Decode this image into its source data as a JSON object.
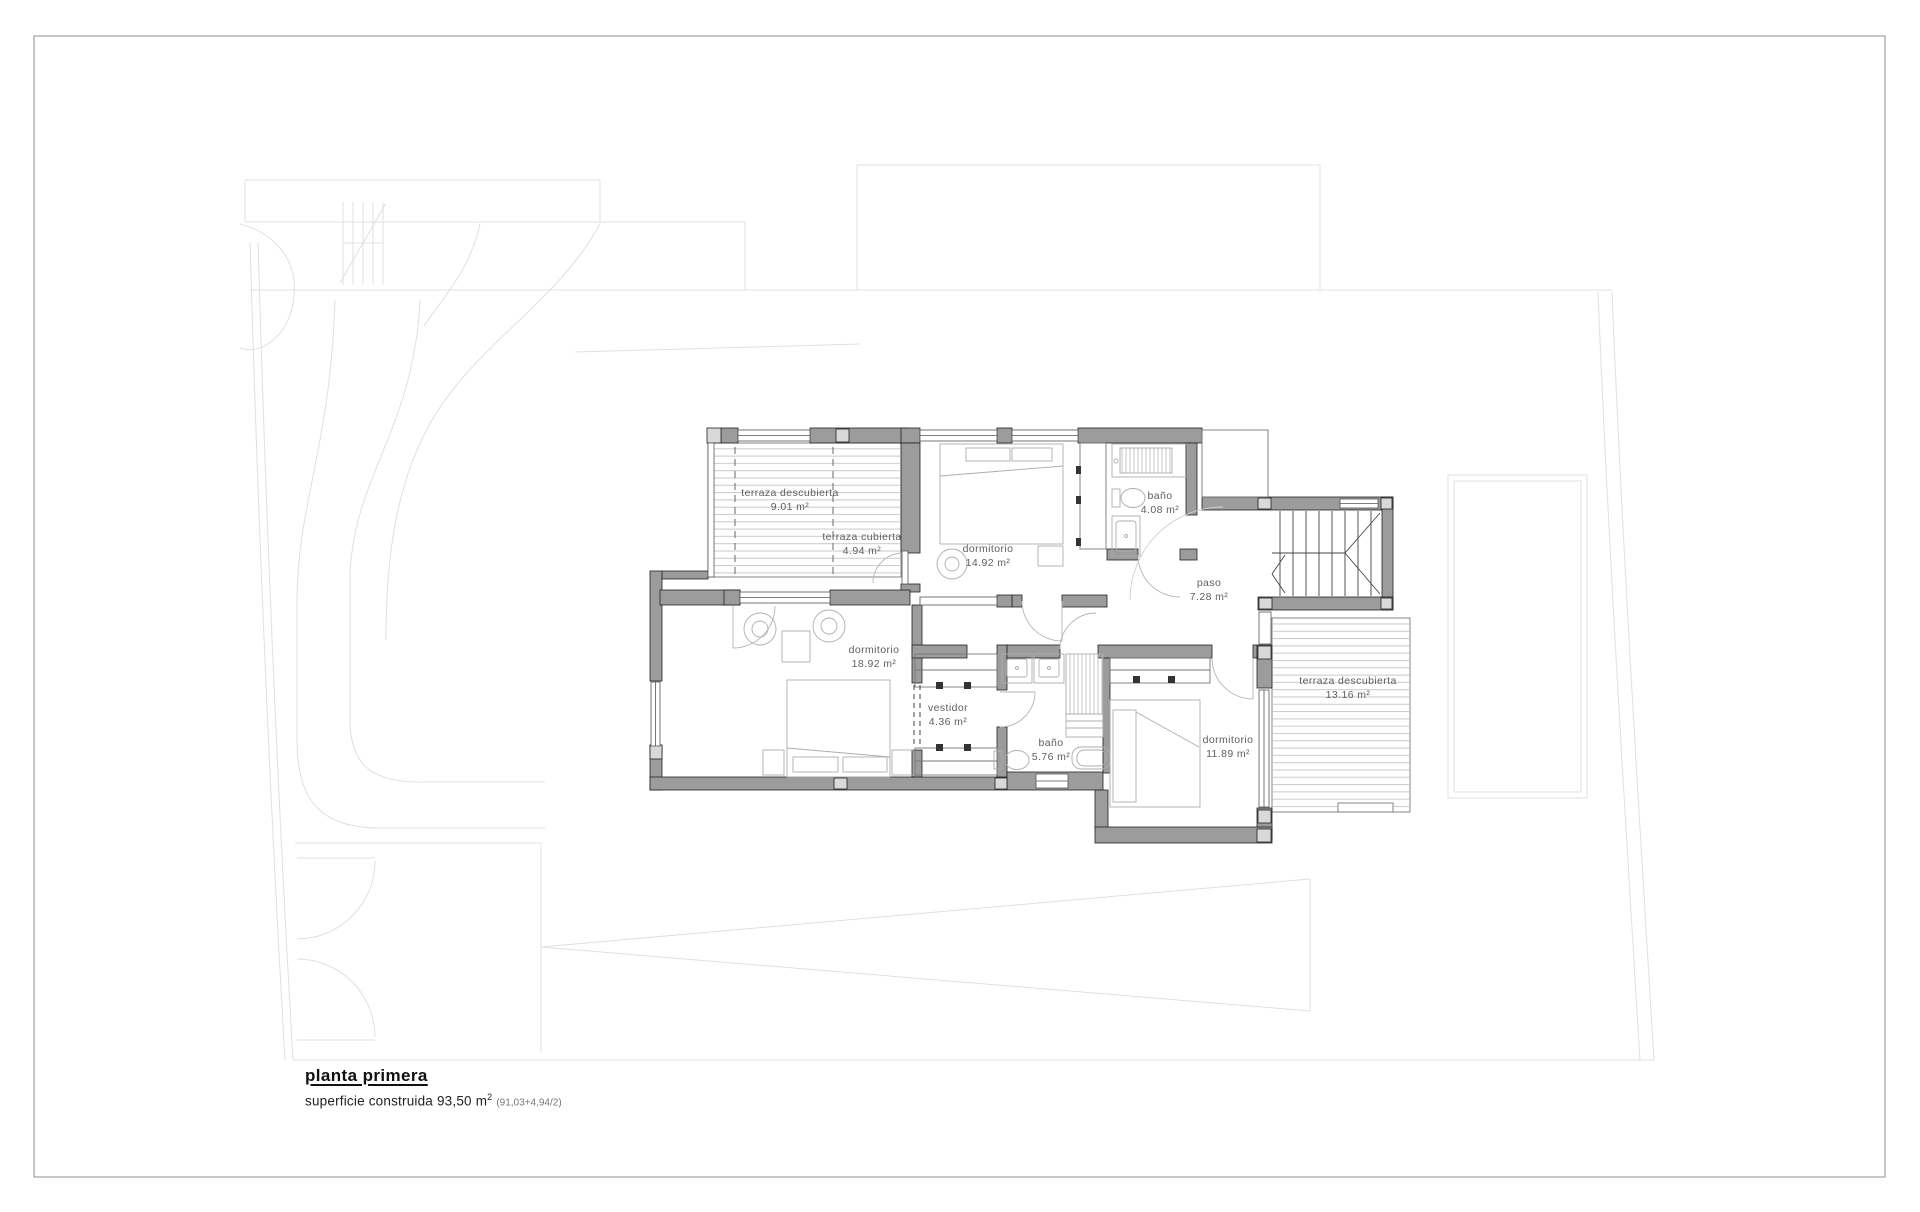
{
  "sheet": {
    "type": "architectural floor plan",
    "language": "es"
  },
  "title_block": {
    "title": "planta primera",
    "area_prefix": "superficie construida 93,50 m",
    "area_sup": "2",
    "area_note": "(91,03+4,94/2)"
  },
  "rooms": [
    {
      "id": "terraza-descubierta-oeste",
      "name": "terraza descubierta",
      "area": "9.01 m²"
    },
    {
      "id": "terraza-cubierta",
      "name": "terraza cubierta",
      "area": "4.94 m²"
    },
    {
      "id": "dormitorio-norte",
      "name": "dormitorio",
      "area": "14.92 m²"
    },
    {
      "id": "bano-norte",
      "name": "baño",
      "area": "4.08 m²"
    },
    {
      "id": "paso",
      "name": "paso",
      "area": "7.28 m²"
    },
    {
      "id": "dormitorio-principal",
      "name": "dormitorio",
      "area": "18.92 m²"
    },
    {
      "id": "vestidor",
      "name": "vestidor",
      "area": "4.36 m²"
    },
    {
      "id": "bano-principal",
      "name": "baño",
      "area": "5.76 m²"
    },
    {
      "id": "dormitorio-este",
      "name": "dormitorio",
      "area": "11.89 m²"
    },
    {
      "id": "terraza-descubierta-este",
      "name": "terraza descubierta",
      "area": "13.16 m²"
    }
  ],
  "palette": {
    "wall_fill": "#9c9c9c",
    "pillar_fill": "#d9d9d9",
    "wall_stroke": "#222222",
    "terrace_hatch": "#c9c9c9",
    "furniture_stroke": "#adadad",
    "site_underlay": "#e0e0e0",
    "label_color": "#5f5f5f"
  }
}
